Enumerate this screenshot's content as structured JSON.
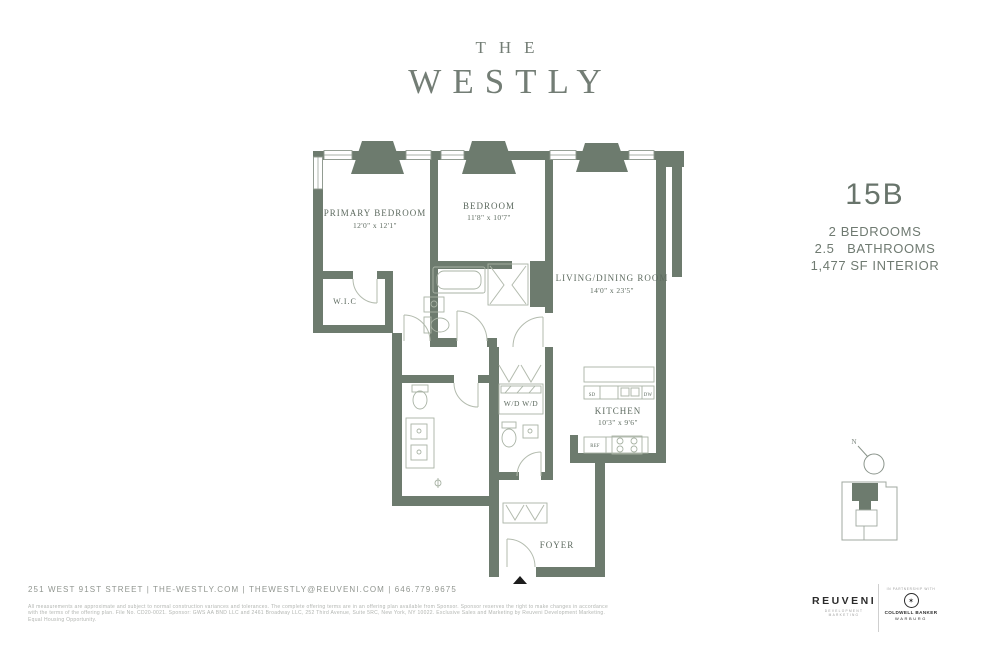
{
  "brand": {
    "the": "THE",
    "westly": "WESTLY"
  },
  "unit": {
    "number": "15B",
    "specs": [
      "2 BEDROOMS",
      "2.5   BATHROOMS",
      "1,477 SF INTERIOR"
    ]
  },
  "rooms": {
    "primary_bedroom": {
      "name": "PRIMARY BEDROOM",
      "dims": "12'0\" x 12'1\""
    },
    "bedroom": {
      "name": "BEDROOM",
      "dims": "11'8\" x 10'7\""
    },
    "living": {
      "name": "LIVING/DINING ROOM",
      "dims": "14'0\" x 23'5\""
    },
    "kitchen": {
      "name": "KITCHEN",
      "dims": "10'3\" x 9'6\""
    },
    "wic": "W.I.C",
    "foyer": "FOYER",
    "wd": "W/D W/D",
    "sd": "SD",
    "dw": "DW",
    "ref": "REF"
  },
  "compass": {
    "n": "N"
  },
  "footer": {
    "contact": "251 WEST 91ST STREET  |  THE-WESTLY.COM  |  THEWESTLY@REUVENI.COM  |  646.779.9675",
    "disclaimer": "All measurements are approximate and subject to normal construction variances and tolerances. The complete offering terms are in an offering plan available from Sponsor. Sponsor reserves the right to make changes in accordance with the terms of the offering plan. File No. CD20-0021. Sponsor: GWS AA BND LLC and 2461 Broadway LLC, 252 Third Avenue, Suite 5RC, New York, NY 10022. Exclusive Sales and Marketing by Reuveni Development Marketing. Equal Housing Opportunity.",
    "reuveni": {
      "name": "REUVENI",
      "tagline": "DEVELOPMENT MARKETING"
    },
    "partner": {
      "pretext": "IN PARTNERSHIP WITH",
      "star": "✶",
      "line1": "COLDWELL BANKER",
      "line2": "WARBURG"
    }
  },
  "colors": {
    "wall": "#6d7b6e",
    "brand": "#737d75",
    "label": "#5e6b60",
    "fine": "#b2b5b1"
  }
}
